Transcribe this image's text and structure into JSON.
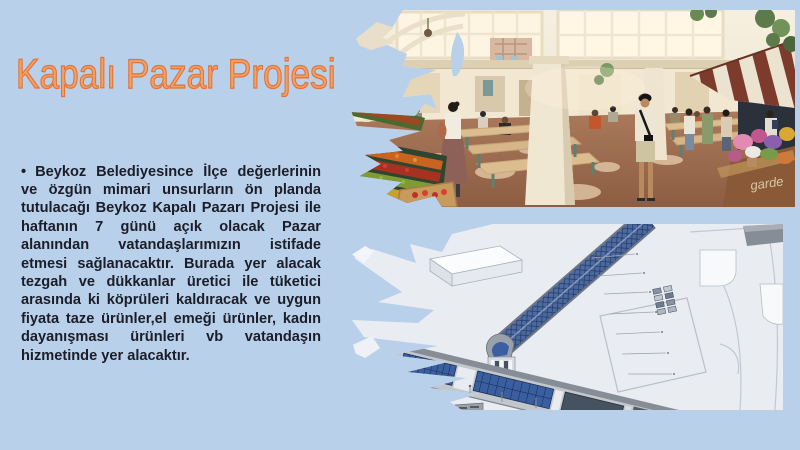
{
  "slide": {
    "background_color": "#b9d0ea",
    "title": {
      "text": "Kapalı Pazar Projesi",
      "fill": "#f2a167",
      "outline": "#e0753a"
    },
    "body": {
      "bullet": "•",
      "text": "Beykoz Belediyesince İlçe değerlerinin ve özgün mimari unsurların ön planda tutulacağı Beykoz Kapalı Pazarı Projesi ile haftanın 7 günü açık olacak Pazar alanından vatandaşlarımızın istifade etmesi sağlanacaktır. Burada yer alacak tezgah ve dükkanlar üretici ile tüketici arasında ki köprüleri kaldıracak ve uygun fiyata taze ürünler,el emeği ürünler, kadın dayanışması ürünleri vb vatandaşın hizmetinde yer alacaktır.",
      "color": "#1b1d29"
    },
    "images": {
      "top": {
        "alt": "kapalı pazar iç mekan canlandırması",
        "stall_sign_text": "garde"
      },
      "bottom": {
        "alt": "kapalı pazar binası havadan mimari canlandırma"
      }
    }
  }
}
